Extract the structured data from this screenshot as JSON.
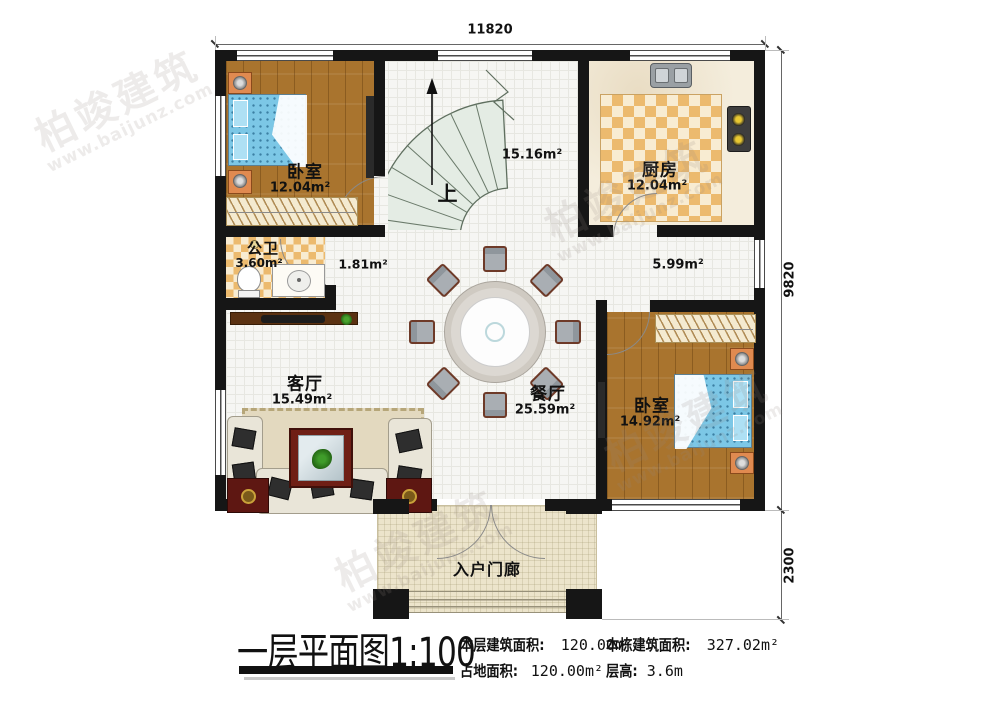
{
  "plan": {
    "dimensions": {
      "top": "11820",
      "side_main": "9820",
      "side_porch": "2300"
    },
    "rooms": {
      "bedroom_top_left": {
        "name": "卧室",
        "area": "12.04m²"
      },
      "kitchen": {
        "name": "厨房",
        "area": "12.04m²"
      },
      "stair_hall": {
        "area": "15.16m²",
        "up_label": "上"
      },
      "bathroom": {
        "name": "公卫",
        "area": "3.60m²"
      },
      "hallway_small": {
        "area": "1.81m²"
      },
      "corridor": {
        "area": "5.99m²"
      },
      "living_room": {
        "name": "客厅",
        "area": "15.49m²"
      },
      "dining_room": {
        "name": "餐厅",
        "area": "25.59m²"
      },
      "bedroom_right": {
        "name": "卧室",
        "area": "14.92m²"
      },
      "porch": {
        "name": "入户门廊"
      }
    }
  },
  "title_block": {
    "title": "一层平面图",
    "scale": "1:100",
    "stats": [
      {
        "label": "本层建筑面积:",
        "value": "120.00m²"
      },
      {
        "label": "本栋建筑面积:",
        "value": "327.02m²"
      },
      {
        "label": "占地面积:",
        "value": "120.00m²"
      },
      {
        "label": "层高:",
        "value": "3.6m"
      }
    ]
  },
  "watermark": {
    "brand": "柏竣建筑",
    "url": "www.baijunz.com"
  },
  "colors": {
    "wall": "#161616",
    "wood_floor": "#a9742e",
    "tile_checker": "#ecba6e",
    "bed": "#7cc7e6",
    "stairs": "#e6eee6"
  }
}
